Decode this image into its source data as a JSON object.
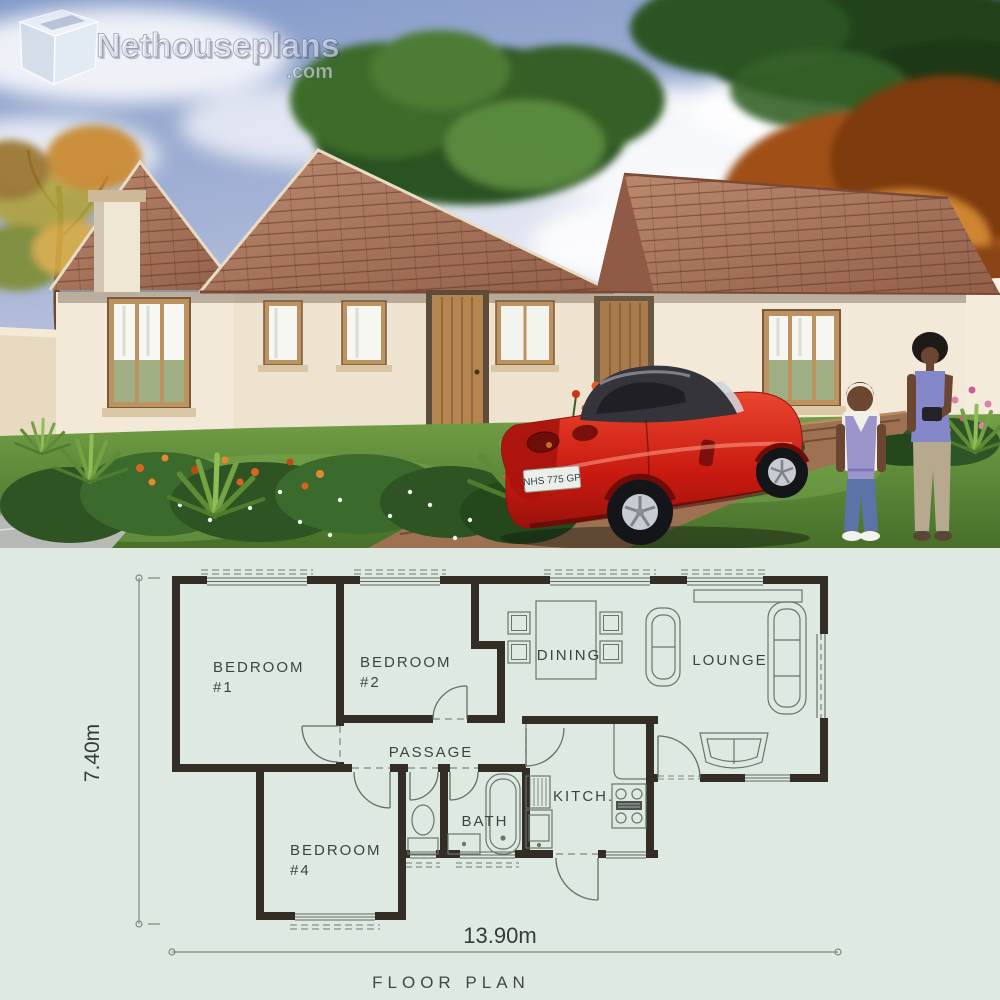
{
  "logo": {
    "brand": "Nethouseplans",
    "suffix": ".com"
  },
  "photo": {
    "license_plate": "NHS 775 GP"
  },
  "floor_plan": {
    "title": "FLOOR PLAN",
    "width_label": "13.90m",
    "height_label": "7.40m",
    "rooms": {
      "bedroom1_line1": "BEDROOM",
      "bedroom1_line2": "#1",
      "bedroom2_line1": "BEDROOM",
      "bedroom2_line2": "#2",
      "bedroom4_line1": "BEDROOM",
      "bedroom4_line2": "#4",
      "dining": "DINING",
      "lounge": "LOUNGE",
      "passage": "PASSAGE",
      "bath": "BATH",
      "kitchen": "KITCH."
    }
  },
  "colors": {
    "plan_background": "#dee9e2",
    "plan_wall": "#332d25",
    "plan_line": "#67766b",
    "plan_text": "#3b453e",
    "sky": "#8fa2cc",
    "roof_tile": "#a06a50",
    "house_wall": "#f2e9d8",
    "lawn": "#5d8a3a",
    "car_red": "#c82014"
  }
}
